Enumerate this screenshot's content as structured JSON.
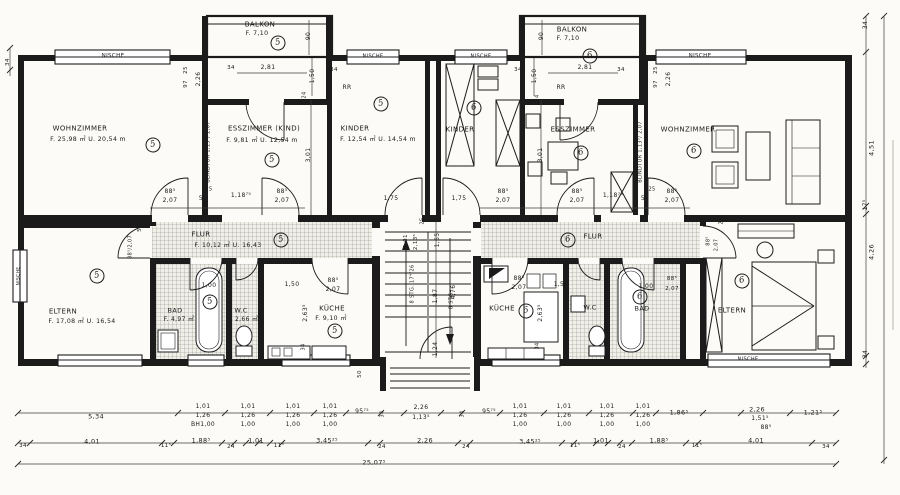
{
  "document": {
    "type": "architectural floor plan",
    "language": "de"
  },
  "colors": {
    "paper": "#fcfbf7",
    "ink": "#1b1b1b",
    "hatch": "#8d8d86"
  },
  "apartments": {
    "left": {
      "number": "5",
      "rooms": [
        "WOHNZIMMER",
        "ESSZIMMER (KIND)",
        "KINDER",
        "BALKON",
        "FLUR",
        "ELTERN",
        "BAD",
        "W.C",
        "KÜCHE"
      ]
    },
    "right": {
      "number": "6",
      "rooms": [
        "KINDER",
        "ESSZIMMER",
        "WOHNZIMMER",
        "BALKON",
        "FLUR",
        "KÜCHE",
        "W.C",
        "BAD",
        "ELTERN"
      ]
    }
  },
  "labels": [
    {
      "id": "nische-top-left",
      "t": "NISCHE",
      "x": 113,
      "y": 57,
      "s": 5.5
    },
    {
      "id": "dim-34-left-wall",
      "t": "34",
      "x": 9,
      "y": 62,
      "r": 1,
      "s": 5.5
    },
    {
      "id": "balkon-left-name",
      "t": "BALKON",
      "x": 260,
      "y": 25,
      "s": 7
    },
    {
      "id": "balkon-left-area",
      "t": "F. 7,10",
      "x": 257,
      "y": 34,
      "s": 6.2
    },
    {
      "id": "dim-90-balkon-left",
      "t": "90",
      "x": 309,
      "y": 36,
      "r": 1,
      "s": 6
    },
    {
      "id": "dim-25-top-left",
      "t": "25",
      "x": 187,
      "y": 70,
      "r": 1,
      "s": 5.5
    },
    {
      "id": "dim-97-top-left",
      "t": "97",
      "x": 187,
      "y": 84,
      "r": 1,
      "s": 5.5
    },
    {
      "id": "dim-226-top-left",
      "t": "2,26",
      "x": 199,
      "y": 79,
      "r": 1,
      "s": 6
    },
    {
      "id": "dim-34-balkon-left-a",
      "t": "34",
      "x": 231,
      "y": 69,
      "s": 5.5
    },
    {
      "id": "dim-281-left",
      "t": "2,81",
      "x": 268,
      "y": 68,
      "s": 6
    },
    {
      "id": "dim-150-balkon-left",
      "t": "1,50",
      "x": 313,
      "y": 76,
      "r": 1,
      "s": 6
    },
    {
      "id": "dim-34-balkon-left-b",
      "t": "34",
      "x": 334,
      "y": 71,
      "s": 5.5
    },
    {
      "id": "dim-24-esszimmer-kind",
      "t": "24",
      "x": 305,
      "y": 95,
      "r": 1,
      "s": 5
    },
    {
      "id": "rr-left",
      "t": "RR",
      "x": 347,
      "y": 88,
      "s": 6
    },
    {
      "id": "nische-kinder-left",
      "t": "NISCHE",
      "x": 373,
      "y": 57,
      "s": 5
    },
    {
      "id": "nische-kinder-mid",
      "t": "NISCHE",
      "x": 481,
      "y": 57,
      "s": 5
    },
    {
      "id": "dim-34-balkon-right-a",
      "t": "34",
      "x": 518,
      "y": 71,
      "s": 5.5
    },
    {
      "id": "dim-90-balkon-right",
      "t": "90",
      "x": 542,
      "y": 36,
      "r": 1,
      "s": 6
    },
    {
      "id": "dim-150-balkon-right",
      "t": "1,50",
      "x": 535,
      "y": 76,
      "r": 1,
      "s": 6
    },
    {
      "id": "rr-right",
      "t": "RR",
      "x": 561,
      "y": 88,
      "s": 6
    },
    {
      "id": "balkon-right-name",
      "t": "BALKON",
      "x": 572,
      "y": 30,
      "s": 7
    },
    {
      "id": "balkon-right-area",
      "t": "F. 7,10",
      "x": 568,
      "y": 39,
      "s": 6.2
    },
    {
      "id": "dim-281-right",
      "t": "2,81",
      "x": 585,
      "y": 68,
      "s": 6
    },
    {
      "id": "dim-24-esszimmer-right",
      "t": "24",
      "x": 538,
      "y": 98,
      "r": 1,
      "s": 5
    },
    {
      "id": "dim-34-balkon-right-b",
      "t": "34",
      "x": 621,
      "y": 71,
      "s": 5.5
    },
    {
      "id": "dim-25-top-right",
      "t": "25",
      "x": 657,
      "y": 70,
      "r": 1,
      "s": 5.5
    },
    {
      "id": "dim-97-top-right",
      "t": "97",
      "x": 657,
      "y": 84,
      "r": 1,
      "s": 5.5
    },
    {
      "id": "dim-226-top-right",
      "t": "2,26",
      "x": 669,
      "y": 79,
      "r": 1,
      "s": 6
    },
    {
      "id": "nische-top-right",
      "t": "NISCHE",
      "x": 700,
      "y": 57,
      "s": 5.5
    },
    {
      "id": "wohnzimmer-left-name",
      "t": "WOHNZIMMER",
      "x": 80,
      "y": 129,
      "s": 7
    },
    {
      "id": "wohnzimmer-left-area",
      "t": "F. 25,98 ㎡  U. 20,54 m",
      "x": 88,
      "y": 140,
      "s": 6.2
    },
    {
      "id": "esszimmer-kind-name",
      "t": "ESSZIMMER (KIND)",
      "x": 264,
      "y": 129,
      "s": 7
    },
    {
      "id": "esszimmer-kind-area",
      "t": "F. 9,81 ㎡  U. 12,54 m",
      "x": 262,
      "y": 141,
      "s": 6.2
    },
    {
      "id": "blindtur-left",
      "t": "BLINDTUR 1,13⁵/ 2,07",
      "x": 209,
      "y": 152,
      "r": 1,
      "s": 5
    },
    {
      "id": "dim-301-left",
      "t": "3,01",
      "x": 309,
      "y": 155,
      "r": 1,
      "s": 6
    },
    {
      "id": "kinder-left-name",
      "t": "KINDER",
      "x": 355,
      "y": 129,
      "s": 7
    },
    {
      "id": "kinder-left-area",
      "t": "F. 12,54 ㎡  U. 14,54 m",
      "x": 378,
      "y": 140,
      "s": 6.2
    },
    {
      "id": "kinder-mid-name",
      "t": "KINDER",
      "x": 460,
      "y": 130,
      "s": 7
    },
    {
      "id": "esszimmer-right-name",
      "t": "ESSZIMMER",
      "x": 573,
      "y": 130,
      "s": 7
    },
    {
      "id": "dim-301-right",
      "t": "3,01",
      "x": 541,
      "y": 155,
      "r": 1,
      "s": 6
    },
    {
      "id": "blindtur-right",
      "t": "BLINDTUR 1,13⁵/ 2,07",
      "x": 641,
      "y": 152,
      "r": 1,
      "s": 5
    },
    {
      "id": "wohnzimmer-right-name",
      "t": "WOHNZIMMER",
      "x": 688,
      "y": 130,
      "s": 7
    },
    {
      "id": "dim-34-right-top",
      "t": "34",
      "x": 866,
      "y": 25,
      "r": 1,
      "s": 6
    },
    {
      "id": "dim-451-right",
      "t": "4,51",
      "x": 872,
      "y": 148,
      "r": 1,
      "s": 6.5
    },
    {
      "id": "dim-175-right-col",
      "t": "17⁵",
      "x": 866,
      "y": 205,
      "r": 1,
      "s": 6
    },
    {
      "id": "dim-426-right",
      "t": "4,26",
      "x": 872,
      "y": 252,
      "r": 1,
      "s": 6.5
    },
    {
      "id": "dim-34-right-bottom",
      "t": "34",
      "x": 866,
      "y": 354,
      "r": 1,
      "s": 6
    },
    {
      "id": "dim-door-wohnl-a",
      "t": "88⁵",
      "x": 170,
      "y": 192,
      "s": 6
    },
    {
      "id": "dim-door-wohnl-b",
      "t": "2,07",
      "x": 170,
      "y": 201,
      "s": 6
    },
    {
      "id": "dim-25-doorrow-left",
      "t": "25",
      "x": 209,
      "y": 190,
      "s": 5
    },
    {
      "id": "dim-56-left",
      "t": "56",
      "x": 203,
      "y": 199,
      "s": 6
    },
    {
      "id": "dim-118-left",
      "t": "1,18⁷⁵",
      "x": 241,
      "y": 196,
      "s": 6
    },
    {
      "id": "dim-door-essk-a",
      "t": "88⁵",
      "x": 282,
      "y": 192,
      "s": 6
    },
    {
      "id": "dim-door-essk-b",
      "t": "2,07",
      "x": 282,
      "y": 201,
      "s": 6
    },
    {
      "id": "dim-175-left",
      "t": "1,75",
      "x": 391,
      "y": 199,
      "s": 6
    },
    {
      "id": "dim-175-mid",
      "t": "1,75",
      "x": 459,
      "y": 199,
      "s": 6
    },
    {
      "id": "dim-door-kinderm-a",
      "t": "88⁵",
      "x": 503,
      "y": 192,
      "s": 6
    },
    {
      "id": "dim-door-kinderm-b",
      "t": "2,07",
      "x": 503,
      "y": 201,
      "s": 6
    },
    {
      "id": "dim-door-essr-a",
      "t": "88⁵",
      "x": 577,
      "y": 192,
      "s": 6
    },
    {
      "id": "dim-door-essr-b",
      "t": "2,07",
      "x": 577,
      "y": 201,
      "s": 6
    },
    {
      "id": "dim-118-right",
      "t": "1,18⁷⁵",
      "x": 613,
      "y": 196,
      "s": 6
    },
    {
      "id": "dim-56-right",
      "t": "56",
      "x": 645,
      "y": 199,
      "s": 6
    },
    {
      "id": "dim-25-doorrow-right",
      "t": "25",
      "x": 652,
      "y": 190,
      "s": 5
    },
    {
      "id": "dim-door-wohnr-a",
      "t": "88⁵",
      "x": 672,
      "y": 192,
      "s": 6
    },
    {
      "id": "dim-door-wohnr-b",
      "t": "2,07",
      "x": 672,
      "y": 201,
      "s": 6
    },
    {
      "id": "dim-50-flur-left",
      "t": "50",
      "x": 141,
      "y": 228,
      "r": 1,
      "s": 5.5
    },
    {
      "id": "dim-door-elternl",
      "t": "88⁵/2,07",
      "x": 131,
      "y": 247,
      "r": 1,
      "s": 5
    },
    {
      "id": "flur-left-name",
      "t": "FLUR",
      "x": 201,
      "y": 235,
      "s": 7
    },
    {
      "id": "flur-left-area",
      "t": "F. 10,12 ㎡   U. 16,43",
      "x": 228,
      "y": 246,
      "s": 6.2
    },
    {
      "id": "dim-101-stair",
      "t": "1,01",
      "x": 407,
      "y": 241,
      "r": 1,
      "s": 5.5
    },
    {
      "id": "dim-2135-stair",
      "t": "2,13⁵",
      "x": 417,
      "y": 242,
      "r": 1,
      "s": 5.5
    },
    {
      "id": "dim-25-stair",
      "t": "25",
      "x": 423,
      "y": 221,
      "r": 1,
      "s": 5
    },
    {
      "id": "dim-165-stair",
      "t": "1,65",
      "x": 438,
      "y": 240,
      "r": 1,
      "s": 6
    },
    {
      "id": "flur-right-name",
      "t": "FLUR",
      "x": 593,
      "y": 237,
      "s": 7
    },
    {
      "id": "dim-door-elternr-a",
      "t": "88⁵",
      "x": 709,
      "y": 241,
      "r": 1,
      "s": 5
    },
    {
      "id": "dim-door-elternr-b",
      "t": "2,07",
      "x": 717,
      "y": 245,
      "r": 1,
      "s": 5
    },
    {
      "id": "dim-25-elternr",
      "t": "25",
      "x": 722,
      "y": 221,
      "r": 1,
      "s": 5
    },
    {
      "id": "eltern-left-name",
      "t": "ELTERN",
      "x": 63,
      "y": 312,
      "s": 7
    },
    {
      "id": "eltern-left-area",
      "t": "F. 17,08 ㎡ U. 16,54",
      "x": 82,
      "y": 322,
      "s": 6.2
    },
    {
      "id": "nische-left-wall",
      "t": "NISCHE",
      "x": 20,
      "y": 276,
      "r": 1,
      "s": 4.5
    },
    {
      "id": "bad-left-name",
      "t": "BAD",
      "x": 175,
      "y": 311,
      "s": 6.5
    },
    {
      "id": "bad-left-area",
      "t": "F. 4,97 ㎡",
      "x": 179,
      "y": 320,
      "s": 6
    },
    {
      "id": "dim-100-bad-left",
      "t": "1,00",
      "x": 209,
      "y": 286,
      "s": 6
    },
    {
      "id": "wc-left-name",
      "t": "W.C",
      "x": 241,
      "y": 311,
      "s": 6.5
    },
    {
      "id": "wc-left-area",
      "t": "F. 2,66 ㎡",
      "x": 243,
      "y": 320,
      "s": 6
    },
    {
      "id": "dim-150-wc-left",
      "t": "1,50",
      "x": 292,
      "y": 285,
      "s": 6
    },
    {
      "id": "dim-door-kuechel-a",
      "t": "88⁵",
      "x": 333,
      "y": 281,
      "s": 6
    },
    {
      "id": "dim-door-kuechel-b",
      "t": "2,07",
      "x": 333,
      "y": 290,
      "s": 6
    },
    {
      "id": "kueche-left-name",
      "t": "KÜCHE",
      "x": 332,
      "y": 309,
      "s": 7
    },
    {
      "id": "kueche-left-area",
      "t": "F. 9,10 ㎡",
      "x": 331,
      "y": 319,
      "s": 6.2
    },
    {
      "id": "dim-2635-left",
      "t": "2,63⁵",
      "x": 306,
      "y": 313,
      "r": 1,
      "s": 6
    },
    {
      "id": "dim-34-kueche-left",
      "t": "34",
      "x": 304,
      "y": 347,
      "r": 1,
      "s": 5
    },
    {
      "id": "dim-50-entry-left",
      "t": "50",
      "x": 361,
      "y": 374,
      "r": 1,
      "s": 5.5
    },
    {
      "id": "stair-text-1",
      "t": "8 STG. 17⁴/26",
      "x": 413,
      "y": 284,
      "r": 1,
      "s": 5
    },
    {
      "id": "stair-text-2",
      "t": "8 STG.",
      "x": 452,
      "y": 300,
      "r": 1,
      "s": 5
    },
    {
      "id": "dim-187-stair",
      "t": "1,87",
      "x": 436,
      "y": 296,
      "r": 1,
      "s": 6
    },
    {
      "id": "dim-476-stair",
      "t": "4,76",
      "x": 454,
      "y": 292,
      "r": 1,
      "s": 6
    },
    {
      "id": "dim-124-entry",
      "t": "1,24",
      "x": 436,
      "y": 349,
      "r": 1,
      "s": 6
    },
    {
      "id": "dim-door-kuecher-a",
      "t": "88⁵",
      "x": 519,
      "y": 279,
      "s": 6
    },
    {
      "id": "dim-door-kuecher-b",
      "t": "2,07",
      "x": 519,
      "y": 288,
      "s": 6
    },
    {
      "id": "kueche-right-name",
      "t": "KÜCHE",
      "x": 502,
      "y": 309,
      "s": 7
    },
    {
      "id": "dim-150-kueche-right",
      "t": "1,50",
      "x": 561,
      "y": 285,
      "s": 6
    },
    {
      "id": "dim-2635-right",
      "t": "2,63⁵",
      "x": 541,
      "y": 313,
      "r": 1,
      "s": 6
    },
    {
      "id": "dim-34-kueche-right",
      "t": "34",
      "x": 538,
      "y": 346,
      "r": 1,
      "s": 5
    },
    {
      "id": "wc-right-name",
      "t": "W.C",
      "x": 590,
      "y": 308,
      "s": 6.5
    },
    {
      "id": "dim-100-bad-right",
      "t": "1,00",
      "x": 646,
      "y": 287,
      "s": 6
    },
    {
      "id": "bad-right-name",
      "t": "BAD",
      "x": 642,
      "y": 309,
      "s": 6.5
    },
    {
      "id": "dim-door-badr-a",
      "t": "88⁵",
      "x": 672,
      "y": 280,
      "s": 5.5
    },
    {
      "id": "dim-door-badr-b",
      "t": "2,07",
      "x": 672,
      "y": 290,
      "s": 5.5
    },
    {
      "id": "eltern-right-name",
      "t": "ELTERN",
      "x": 732,
      "y": 311,
      "s": 7
    },
    {
      "id": "nische-eltern-right",
      "t": "NISCHE",
      "x": 748,
      "y": 360,
      "s": 5
    },
    {
      "id": "bdim-534",
      "t": "5,34",
      "x": 96,
      "y": 417,
      "s": 6.5
    },
    {
      "id": "bdim-9575-l",
      "t": "95⁷⁵",
      "x": 362,
      "y": 412,
      "s": 6
    },
    {
      "id": "bdim-34r-l",
      "t": "34",
      "x": 383,
      "y": 414,
      "r": 1,
      "s": 5
    },
    {
      "id": "bdim-226-top",
      "t": "2,26",
      "x": 421,
      "y": 408,
      "s": 6
    },
    {
      "id": "bdim-1135",
      "t": "1,13⁵",
      "x": 421,
      "y": 418,
      "s": 6
    },
    {
      "id": "bdim-34r-r",
      "t": "34",
      "x": 463,
      "y": 414,
      "r": 1,
      "s": 5
    },
    {
      "id": "bdim-9575-r",
      "t": "95⁷⁵",
      "x": 489,
      "y": 412,
      "s": 6
    },
    {
      "id": "bdim-1865",
      "t": "1,86⁵",
      "x": 679,
      "y": 413,
      "s": 6.5
    },
    {
      "id": "bdim-226-r",
      "t": "2,26",
      "x": 757,
      "y": 410,
      "s": 6.5
    },
    {
      "id": "bdim-1515",
      "t": "1,51⁵",
      "x": 760,
      "y": 419,
      "s": 6
    },
    {
      "id": "bdim-885-r",
      "t": "88⁵",
      "x": 766,
      "y": 428,
      "s": 6
    },
    {
      "id": "bdim-1215",
      "t": "1,21⁵",
      "x": 813,
      "y": 413,
      "s": 6.5
    },
    {
      "id": "b2-34-l",
      "t": "34",
      "x": 23,
      "y": 447,
      "s": 5.5
    },
    {
      "id": "b2-401-l",
      "t": "4,01",
      "x": 92,
      "y": 442,
      "s": 6.5
    },
    {
      "id": "b2-115-a",
      "t": "11⁵",
      "x": 166,
      "y": 447,
      "s": 5.5
    },
    {
      "id": "b2-1885-l",
      "t": "1,88⁵",
      "x": 201,
      "y": 441,
      "s": 6.5
    },
    {
      "id": "b2-24-a",
      "t": "24",
      "x": 231,
      "y": 448,
      "s": 5.5
    },
    {
      "id": "b2-101-l",
      "t": "1,01",
      "x": 256,
      "y": 441,
      "s": 6.5
    },
    {
      "id": "b2-115-b",
      "t": "11⁵",
      "x": 279,
      "y": 447,
      "s": 5.5
    },
    {
      "id": "b2-34525-l",
      "t": "3,45²⁵",
      "x": 327,
      "y": 441,
      "s": 6.5
    },
    {
      "id": "b2-24-b",
      "t": "24",
      "x": 382,
      "y": 448,
      "s": 5.5
    },
    {
      "id": "b2-226",
      "t": "2,26",
      "x": 425,
      "y": 441,
      "s": 6.5
    },
    {
      "id": "b2-24-c",
      "t": "24",
      "x": 466,
      "y": 448,
      "s": 5.5
    },
    {
      "id": "b2-34525-r",
      "t": "3,45²⁵",
      "x": 530,
      "y": 442,
      "s": 6.5
    },
    {
      "id": "b2-115-c",
      "t": "11⁵",
      "x": 575,
      "y": 447,
      "s": 5.5
    },
    {
      "id": "b2-101-r",
      "t": "1,01",
      "x": 601,
      "y": 441,
      "s": 6.5
    },
    {
      "id": "b2-24-d",
      "t": "24",
      "x": 622,
      "y": 448,
      "s": 5.5
    },
    {
      "id": "b2-1885-r",
      "t": "1,88⁵",
      "x": 659,
      "y": 441,
      "s": 6.5
    },
    {
      "id": "b2-115-d",
      "t": "11⁵",
      "x": 697,
      "y": 447,
      "s": 5.5
    },
    {
      "id": "b2-401-r",
      "t": "4,01",
      "x": 756,
      "y": 441,
      "s": 6.5
    },
    {
      "id": "b2-34-r",
      "t": "34",
      "x": 826,
      "y": 448,
      "s": 5.5
    },
    {
      "id": "b3-25075",
      "t": "25,07⁵",
      "x": 374,
      "y": 463,
      "s": 6.5
    }
  ],
  "dim_cols": [
    {
      "x": 203,
      "rows": [
        "1,01",
        "1,26",
        "BH1,00"
      ]
    },
    {
      "x": 248,
      "rows": [
        "1,01",
        "1,26",
        "1,00"
      ]
    },
    {
      "x": 293,
      "rows": [
        "1,01",
        "1,26",
        "1,00"
      ]
    },
    {
      "x": 330,
      "rows": [
        "1,01",
        "1,26",
        "1,00"
      ]
    },
    {
      "x": 520,
      "rows": [
        "1,01",
        "1,26",
        "1,00"
      ]
    },
    {
      "x": 564,
      "rows": [
        "1,01",
        "1,26",
        "1,00"
      ]
    },
    {
      "x": 607,
      "rows": [
        "1,01",
        "1,26",
        "1,00"
      ]
    },
    {
      "x": 643,
      "rows": [
        "1,01",
        "1,26",
        "1,00"
      ]
    }
  ],
  "circles": [
    {
      "n": "5",
      "room": "wohnzimmer-left",
      "x": 153,
      "y": 145
    },
    {
      "n": "5",
      "room": "balkon-left",
      "x": 278,
      "y": 43
    },
    {
      "n": "5",
      "room": "esszimmer-kind",
      "x": 272,
      "y": 160
    },
    {
      "n": "5",
      "room": "kinder-left",
      "x": 381,
      "y": 104
    },
    {
      "n": "5",
      "room": "flur-left",
      "x": 281,
      "y": 240
    },
    {
      "n": "5",
      "room": "eltern-left",
      "x": 97,
      "y": 276
    },
    {
      "n": "5",
      "room": "bad-left",
      "x": 210,
      "y": 302
    },
    {
      "n": "5",
      "room": "kueche-left",
      "x": 335,
      "y": 331
    },
    {
      "n": "6",
      "room": "kinder-mid",
      "x": 474,
      "y": 108
    },
    {
      "n": "6",
      "room": "balkon-right",
      "x": 590,
      "y": 56
    },
    {
      "n": "6",
      "room": "esszimmer-right",
      "x": 581,
      "y": 153
    },
    {
      "n": "6",
      "room": "wohnzimmer-right",
      "x": 694,
      "y": 151
    },
    {
      "n": "6",
      "room": "flur-right",
      "x": 568,
      "y": 240
    },
    {
      "n": "6",
      "room": "kueche-right",
      "x": 526,
      "y": 311
    },
    {
      "n": "6",
      "room": "bad-right",
      "x": 640,
      "y": 297
    },
    {
      "n": "6",
      "room": "eltern-right",
      "x": 742,
      "y": 281
    }
  ]
}
